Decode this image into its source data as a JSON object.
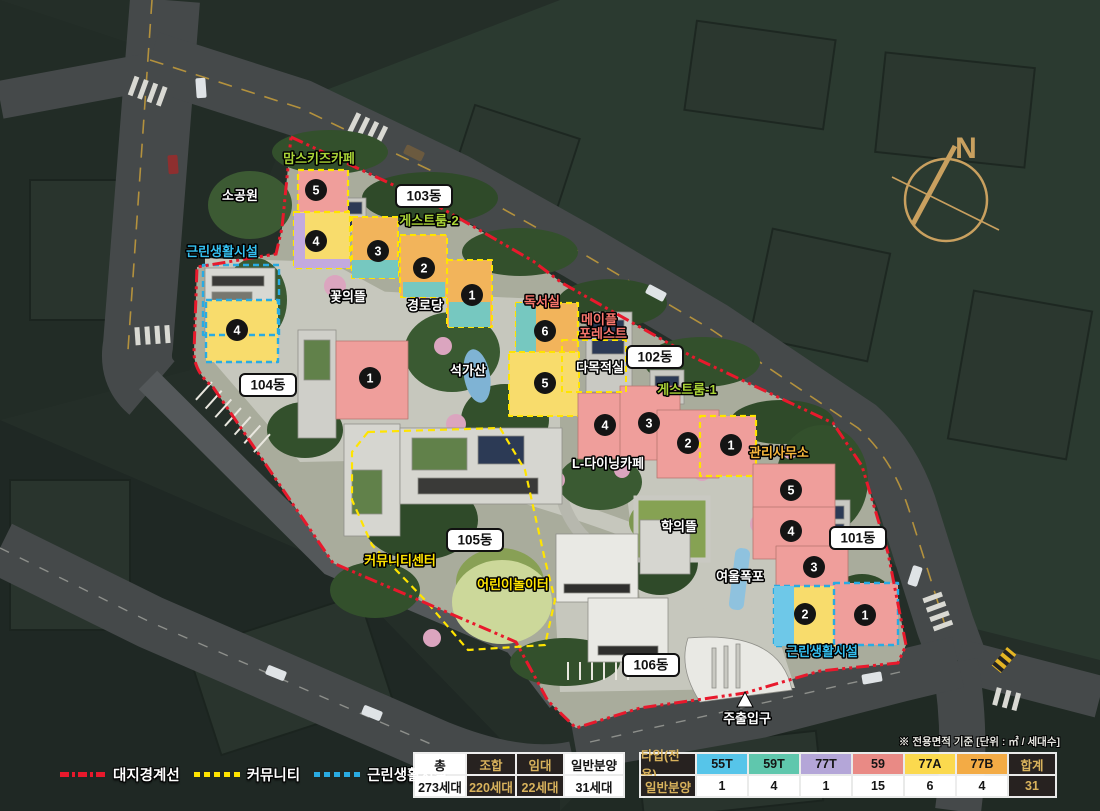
{
  "map": {
    "compass": "N",
    "note": "※ 전용면적 기준 [단위 : ㎡ / 세대수]",
    "dong": {
      "d101": "101동",
      "d102": "102동",
      "d103": "103동",
      "d104": "104동",
      "d105": "105동",
      "d106": "106동"
    },
    "amenities": {
      "moms_kids_cafe": "맘스키즈카페",
      "small_park": "소공원",
      "guest_room_2": "게스트룸-2",
      "neighborhood_facility_left": "근린생활시설",
      "flower_garden": "꽃의뜰",
      "senior_center": "경로당",
      "reading_room": "독서실",
      "maple_line1": "메이플",
      "maple_line2": "포레스트",
      "multipurpose_room": "다목적실",
      "guest_room_1": "게스트룸-1",
      "stone_garden": "석가산",
      "mgmt_office": "관리사무소",
      "l_dining_cafe": "L-다이닝카페",
      "community_center": "커뮤니티센터",
      "children_playground": "어린이놀이터",
      "hakui_garden": "학의뜰",
      "yeoul_waterfall": "여울폭포",
      "neighborhood_facility_right": "근린생활시설",
      "main_entrance": "주출입구"
    },
    "units": {
      "b103": [
        "5",
        "4",
        "3",
        "2",
        "1"
      ],
      "b102": [
        "6",
        "5",
        "4",
        "3",
        "2",
        "1"
      ],
      "b101": [
        "5",
        "4",
        "3",
        "2",
        "1"
      ],
      "b104": [
        "4",
        "1"
      ]
    }
  },
  "legend": {
    "site_boundary": "대지경계선",
    "community": "커뮤니티",
    "neighborhood_facility": "근린생활시설"
  },
  "summary_table": {
    "col1_label": "총",
    "col1_value": "273세대",
    "col2_label": "조합",
    "col2_value": "220세대",
    "col3_label": "임대",
    "col3_value": "22세대",
    "col4_label": "일반분양",
    "col4_value": "31세대"
  },
  "type_table": {
    "row1_header": "타입(전용)",
    "row2_header": "일반분양",
    "types": [
      {
        "label": "55T",
        "count": "1",
        "color": "#56c5e9"
      },
      {
        "label": "59T",
        "count": "4",
        "color": "#5fc7ad"
      },
      {
        "label": "77T",
        "count": "1",
        "color": "#b4a6d8"
      },
      {
        "label": "59",
        "count": "15",
        "color": "#e98a85"
      },
      {
        "label": "77A",
        "count": "6",
        "color": "#fbd94e"
      },
      {
        "label": "77B",
        "count": "4",
        "color": "#f3ab45"
      }
    ],
    "total_label": "합계",
    "total_value": "31"
  },
  "palette": {
    "boundary_red": "#e8192c",
    "community_yellow": "#ffe400",
    "facility_cyan": "#29abe2",
    "unit_pink": "#ef9e9b",
    "unit_yellow": "#f8dc6c",
    "unit_orange": "#f2b45b",
    "unit_teal": "#76c8c0",
    "unit_purple": "#c3aade",
    "unit_cyan": "#6ec8e8"
  }
}
